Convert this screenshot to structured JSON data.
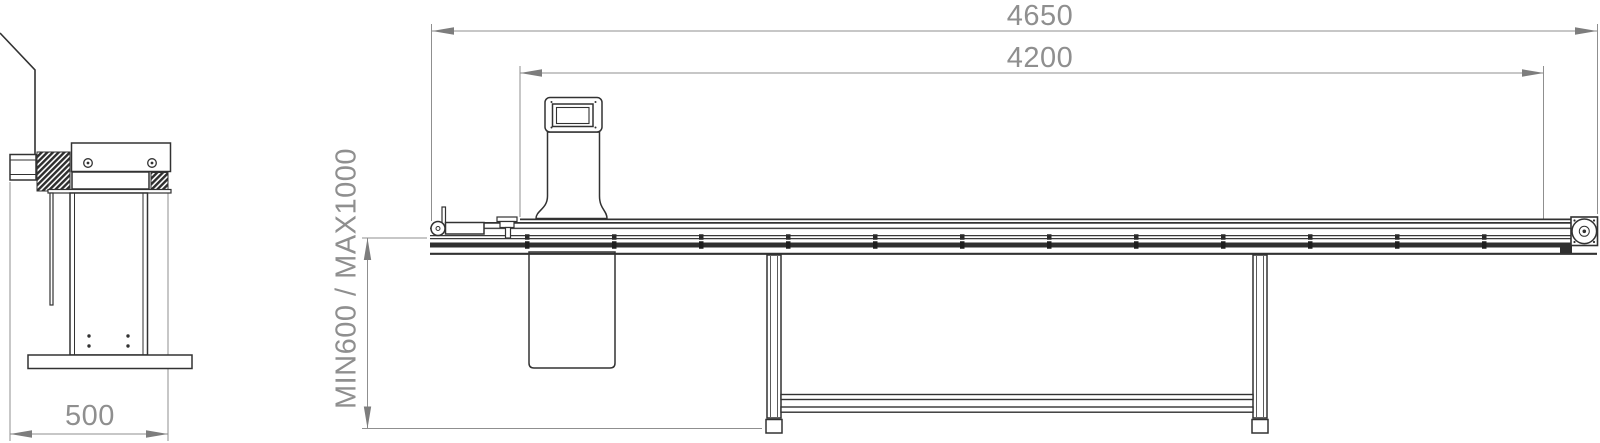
{
  "drawing": {
    "kind": "technical-engineering-drawing",
    "views": {
      "end_view_name": "end-view",
      "side_view_name": "side-view"
    },
    "dimensions": {
      "overall_length": "4650",
      "conveyor_length": "4200",
      "working_height": "MIN600 / MAX1000",
      "end_view_width": "500"
    },
    "colors": {
      "line": "#323232",
      "dimension_line": "#8f8f8f",
      "arrow": "#7d7d7d",
      "background": "#ffffff"
    }
  }
}
